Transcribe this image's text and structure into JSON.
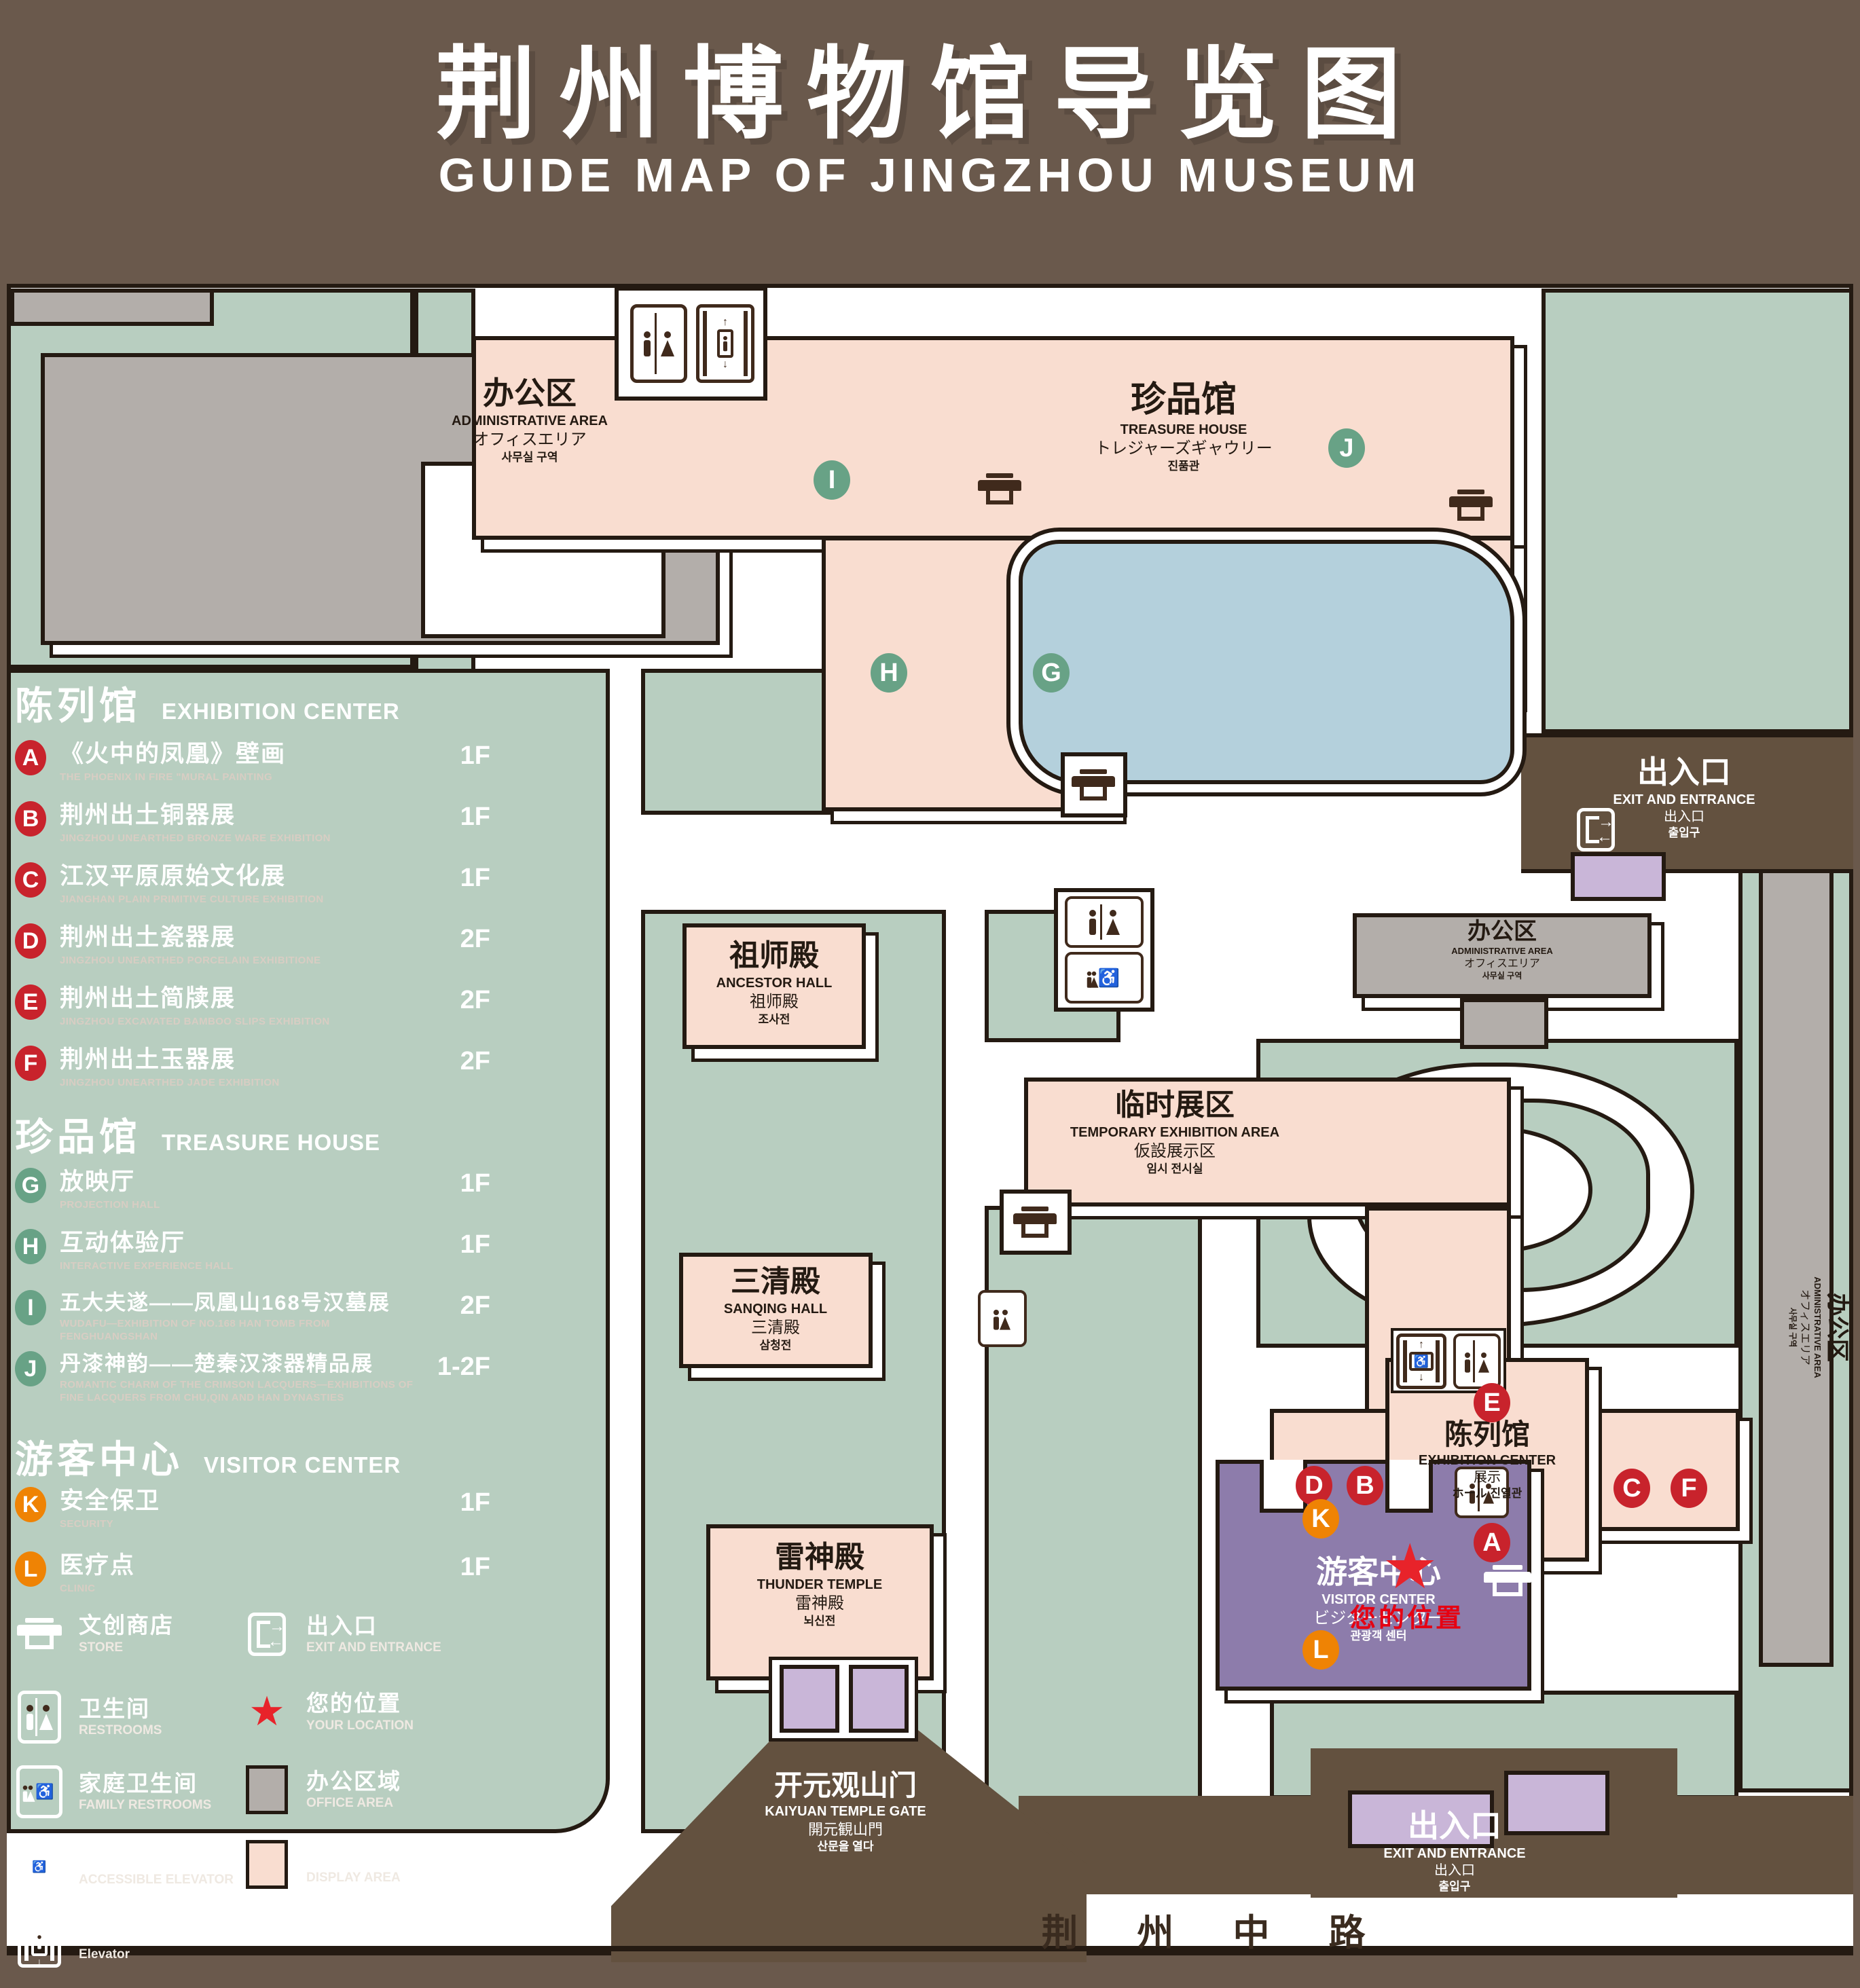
{
  "title": {
    "zh": "荆州博物馆导览图",
    "en": "GUIDE MAP OF JINGZHOU MUSEUM"
  },
  "legend": {
    "sections": [
      {
        "zh": "陈列馆",
        "en": "EXHIBITION CENTER",
        "items": [
          {
            "letter": "A",
            "zh": "《火中的凤凰》壁画",
            "en": "THE PHOENIX IN FIRE \"MURAL PAINTING",
            "floor": "1F"
          },
          {
            "letter": "B",
            "zh": "荆州出土铜器展",
            "en": "JINGZHOU UNEARTHED BRONZE WARE EXHIBITION",
            "floor": "1F"
          },
          {
            "letter": "C",
            "zh": "江汉平原原始文化展",
            "en": "JIANGHAN PLAIN PRIMITIVE CULTURE EXHIBITION",
            "floor": "1F"
          },
          {
            "letter": "D",
            "zh": "荆州出土瓷器展",
            "en": "JINGZHOU UNEARTHED PORCELAIN EXHIBITIONE",
            "floor": "2F"
          },
          {
            "letter": "E",
            "zh": "荆州出土简牍展",
            "en": "JINGZHOU EXCAVATED BAMBOO SLIPS EXHIBITION",
            "floor": "2F"
          },
          {
            "letter": "F",
            "zh": "荆州出土玉器展",
            "en": "JINGZHOU UNEARTHED JADE EXHIBITION",
            "floor": "2F"
          }
        ]
      },
      {
        "zh": "珍品馆",
        "en": "TREASURE HOUSE",
        "items": [
          {
            "letter": "G",
            "zh": "放映厅",
            "en": "PROJECTION HALL",
            "floor": "1F"
          },
          {
            "letter": "H",
            "zh": "互动体验厅",
            "en": "INTERACTIVE EXPERIENCE HALL",
            "floor": "1F"
          },
          {
            "letter": "I",
            "zh": "五大夫遂——凤凰山168号汉墓展",
            "en": "WUDAFU—EXHIBITION OF NO.168 HAN TOMB FROM FENGHUANGSHAN",
            "floor": "2F"
          },
          {
            "letter": "J",
            "zh": "丹漆神韵——楚秦汉漆器精品展",
            "en": "ROMANTIC CHARM OF THE CRIMSON LACQUERS—EXHIBITIONS OF FINE LACQUERS FROM CHU,QIN AND HAN DYNASTIES",
            "floor": "1-2F"
          }
        ]
      },
      {
        "zh": "游客中心",
        "en": "VISITOR CENTER",
        "items": [
          {
            "letter": "K",
            "zh": "安全保卫",
            "en": "SECURITY",
            "floor": "1F"
          },
          {
            "letter": "L",
            "zh": "医疗点",
            "en": "CLINIC",
            "floor": "1F"
          }
        ]
      }
    ],
    "symbols": [
      {
        "icon": "store-icon",
        "zh": "文创商店",
        "en": "STORE"
      },
      {
        "icon": "exit-icon",
        "zh": "出入口",
        "en": "EXIT AND ENTRANCE"
      },
      {
        "icon": "restroom-icon",
        "zh": "卫生间",
        "en": "RESTROOMS"
      },
      {
        "icon": "your-location-star-icon",
        "zh": "您的位置",
        "en": "YOUR LOCATION"
      },
      {
        "icon": "family-restroom-icon",
        "zh": "家庭卫生间",
        "en": "FAMILY RESTROOMS"
      },
      {
        "icon": "office-area-swatch",
        "zh": "办公区域",
        "en": "OFFICE AREA"
      },
      {
        "icon": "accessible-elevator-icon",
        "zh": "无障碍电梯",
        "en": "ACCESSIBLE ELEVATOR"
      },
      {
        "icon": "display-area-swatch",
        "zh": "展示区域",
        "en": "DISPLAY AREA"
      },
      {
        "icon": "elevator-icon",
        "zh": "电梯",
        "en": "Elevator"
      }
    ]
  },
  "map": {
    "admin_nw": {
      "l1": "办公区",
      "l2": "ADMINISTRATIVE AREA",
      "l3": "オフィスエリア",
      "l4": "사무실 구역"
    },
    "admin_e": {
      "l1": "办公区",
      "l2": "ADMINISTRATIVE AREA",
      "l3": "オフィスエリア",
      "l4": "사무실 구역"
    },
    "admin_strip": {
      "l1": "办公区",
      "l2": "ADMINISTRATIVE AREA",
      "l3": "オフィスエリア",
      "l4": "사무실 구역"
    },
    "treasure": {
      "l1": "珍品馆",
      "l2": "TREASURE HOUSE",
      "l3": "トレジャーズギャウリー",
      "l4": "진품관"
    },
    "ancestor": {
      "l1": "祖师殿",
      "l2": "ANCESTOR HALL",
      "l3": "祖师殿",
      "l4": "조사전"
    },
    "temp": {
      "l1": "临时展区",
      "l2": "TEMPORARY EXHIBITION AREA",
      "l3": "仮設展示区",
      "l4": "임시 전시실"
    },
    "sanqing": {
      "l1": "三清殿",
      "l2": "SANQING HALL",
      "l3": "三清殿",
      "l4": "삼청전"
    },
    "thunder": {
      "l1": "雷神殿",
      "l2": "THUNDER TEMPLE",
      "l3": "雷神殿",
      "l4": "뇌신전"
    },
    "visitor": {
      "l1": "游客中心",
      "l2": "VISITOR CENTER",
      "l3": "ビジターセンター",
      "l4": "관광객 센터"
    },
    "exhibition": {
      "l1": "陈列馆",
      "l2": "EXHIBITION CENTER",
      "l3": "展示",
      "l4": "ホール 진열관"
    },
    "exit_ne": {
      "l1": "出入口",
      "l2": "EXIT AND ENTRANCE",
      "l3": "出入口",
      "l4": "출입구"
    },
    "exit_s": {
      "l1": "出入口",
      "l2": "EXIT AND ENTRANCE",
      "l3": "出入口",
      "l4": "출입구"
    },
    "gate": {
      "l1": "开元观山门",
      "l2": "KAIYUAN TEMPLE GATE",
      "l3": "開元観山門",
      "l4": "산문을 열다"
    },
    "road": {
      "name": "荆 州 中 路"
    },
    "your_location": {
      "label": "您的位置"
    },
    "markers": [
      {
        "letter": "A"
      },
      {
        "letter": "B"
      },
      {
        "letter": "C"
      },
      {
        "letter": "D"
      },
      {
        "letter": "E"
      },
      {
        "letter": "F"
      },
      {
        "letter": "G"
      },
      {
        "letter": "H"
      },
      {
        "letter": "I"
      },
      {
        "letter": "J"
      },
      {
        "letter": "K"
      },
      {
        "letter": "L"
      }
    ]
  },
  "colors": {
    "background": "#6a594c",
    "park_green": "#b8cec0",
    "display_area": "#f9ddd0",
    "office_area": "#b3aeaa",
    "water": "#b4d0dc",
    "visitor_center": "#8d7cab",
    "gate_purple": "#c9b6d8",
    "marker_red": "#c8232c",
    "marker_green": "#68a286",
    "marker_orange": "#ef8304",
    "location_red": "#e60012",
    "outline": "#241a12"
  }
}
